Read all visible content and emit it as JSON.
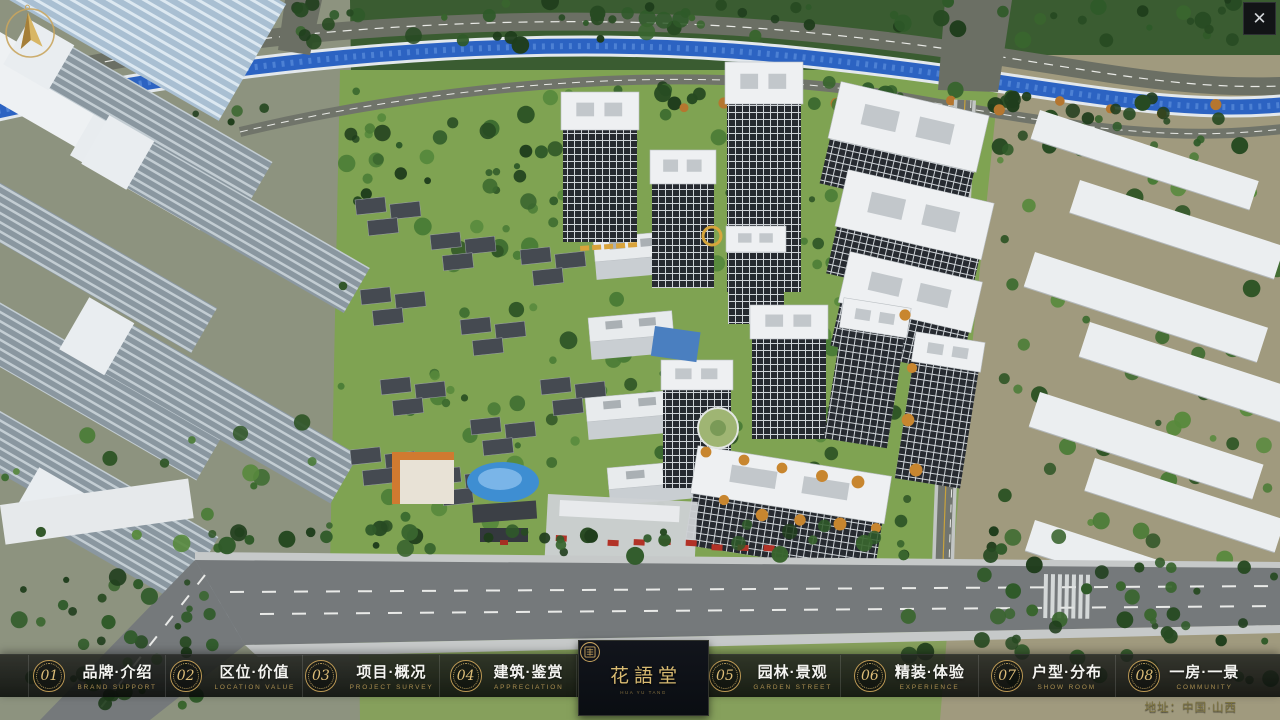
{
  "window": {
    "close_glyph": "✕"
  },
  "nav": {
    "items": [
      {
        "num": "01",
        "label": "品牌·介绍",
        "sub": "BRAND SUPPORT"
      },
      {
        "num": "02",
        "label": "区位·价值",
        "sub": "LOCATION VALUE"
      },
      {
        "num": "03",
        "label": "项目·概况",
        "sub": "PROJECT SURVEY"
      },
      {
        "num": "04",
        "label": "建筑·鉴赏",
        "sub": "APPRECIATION"
      },
      {
        "num": "05",
        "label": "园林·景观",
        "sub": "GARDEN STREET"
      },
      {
        "num": "06",
        "label": "精装·体验",
        "sub": "EXPERIENCE"
      },
      {
        "num": "07",
        "label": "户型·分布",
        "sub": "SHOW ROOM"
      },
      {
        "num": "08",
        "label": "一房·一景",
        "sub": "COMMUNITY"
      }
    ]
  },
  "logo": {
    "title": "花語堂",
    "tagline": "HUA YU TANG"
  },
  "footer": {
    "address": "地址：中国·山西"
  },
  "colors": {
    "gold": "#c9a662",
    "bar_bg": "#0c0e0c",
    "logo_bg": "#0d1016",
    "river": "#2c63c2"
  }
}
